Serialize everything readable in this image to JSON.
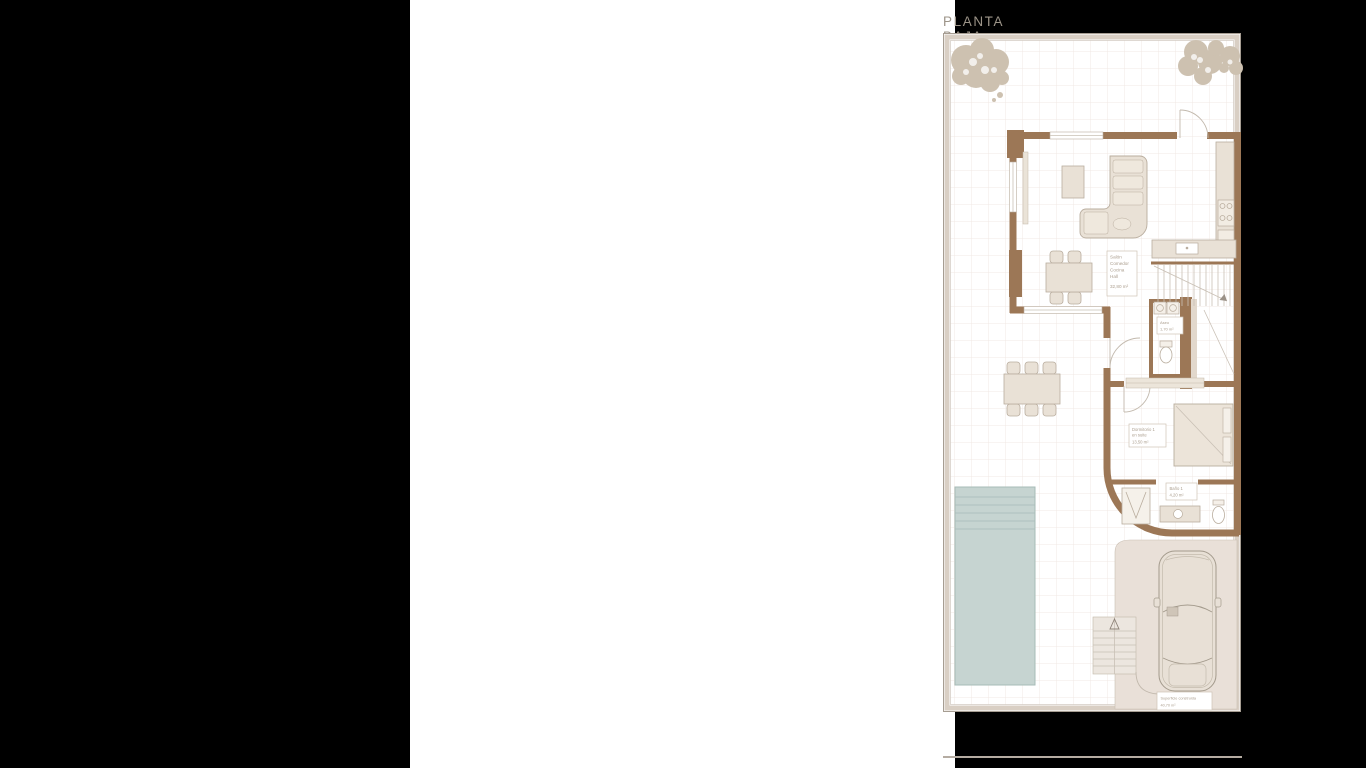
{
  "title": "PLANTA BAJA",
  "rooms": {
    "salon": {
      "line1": "Salón",
      "line2": "Comedor",
      "line3": "Cocina",
      "line4": "Hall",
      "area": "32,80 m²"
    },
    "aseo": {
      "name": "Aseo",
      "area": "1,70 m²"
    },
    "dormitorio": {
      "line1": "Dormitorio 1",
      "line2": "en suite",
      "area": "13,50 m²"
    },
    "bano": {
      "name": "Baño 1",
      "area": "4,20 m²"
    },
    "garaje": {
      "name": "Superficie construida",
      "area": "40,70 m²"
    }
  },
  "colors": {
    "canvas_bg": "#000000",
    "page_bg": "#ffffff",
    "title_text": "#9c9488",
    "wall_brown": "#9c7756",
    "plot_band": "#d9cfc4",
    "tile_line": "#f1e9e4",
    "furniture_fill": "#e9e1d6",
    "furniture_stroke": "#b9ad9e",
    "pool_fill": "#c6d4d1",
    "pool_stroke": "#a7bbb7",
    "tree_fill": "#cdc1b0",
    "garage_floor": "#e9e0d8",
    "label_text": "#ab9e8e"
  }
}
